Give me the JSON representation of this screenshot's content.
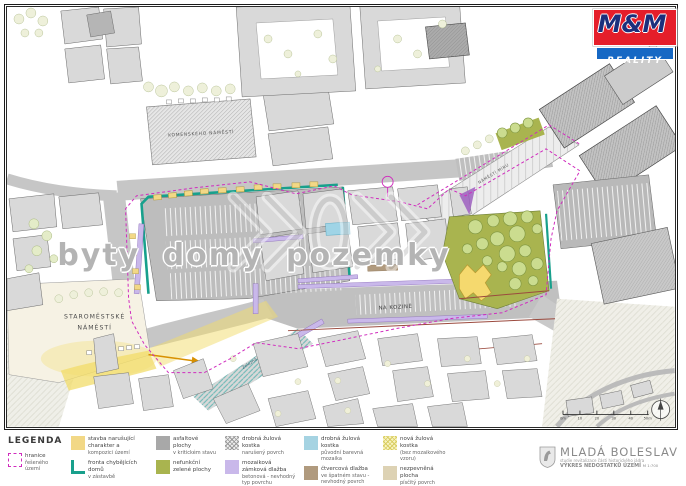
{
  "brand": {
    "top": "M&M",
    "bottom": "REALITY",
    "red": "#e51e2a",
    "blue": "#1668c4",
    "navy": "#1c2f7c"
  },
  "watermark": {
    "text": "byty domy pozemky"
  },
  "map": {
    "labels": {
      "komenskeho": "KOMENSKÉHO NÁMĚSTÍ",
      "staromestske_1": "STAROMĚSTSKÉ",
      "staromestske_2": "NÁMĚSTÍ",
      "na_kozine": "NA KOZINĚ",
      "namesti_miru": "NÁMĚSTÍ MÍRU",
      "zelezna": "Železná"
    },
    "scalebar": {
      "labels": [
        "0m",
        "10",
        "20",
        "30",
        "40",
        "50m"
      ]
    }
  },
  "legend": {
    "title": "LEGENDA",
    "items": [
      {
        "label": "hranice",
        "label2": "řešeného území"
      },
      {
        "label": "stavba narušující charakter a",
        "label2": "kompozici území"
      },
      {
        "label": "fronta chybějících domů",
        "label2": "v zástavbě"
      },
      {
        "label": "asfaltové plochy",
        "label2": "v kritickém stavu"
      },
      {
        "label": "nefunkční zelené plochy",
        "label2": ""
      },
      {
        "label": "drobná žulová kostka",
        "label2": "narušený povrch"
      },
      {
        "label": "mozaiková zámková dlažba",
        "label2": "betonová - nevhodný typ povrchu"
      },
      {
        "label": "drobná žulová kostka",
        "label2": "původní barevná mozaika"
      },
      {
        "label": "čtvercová dlažba",
        "label2": "ve špatném stavu - nevhodný povrch"
      },
      {
        "label": "nová žulová kostka",
        "label2": "(bez mozaikového vzoru)"
      },
      {
        "label": "nezpevněná plocha",
        "label2": "písčitý povrch"
      }
    ]
  },
  "titleblock": {
    "city": "MLADÁ BOLESLAV",
    "subtitle": "studie revitalizace části historického jádra",
    "drawing": "VÝKRES NEDOSTATKŮ ÚZEMÍ",
    "scale": "M 1:700"
  },
  "colors": {
    "street_gray": "#c6c6c6",
    "building_gray": "#d9d9d9",
    "park_olive": "#a9b44f",
    "tree_green": "#cbdc8f",
    "highlight_yellow": "#f2dc6a",
    "teal_line": "#18a08c",
    "purple_paving": "#c9b8ea",
    "cyan_paving": "#9fd4e6",
    "boundary_magenta": "#d02cbe",
    "brown_edge": "#9b4a3e"
  }
}
